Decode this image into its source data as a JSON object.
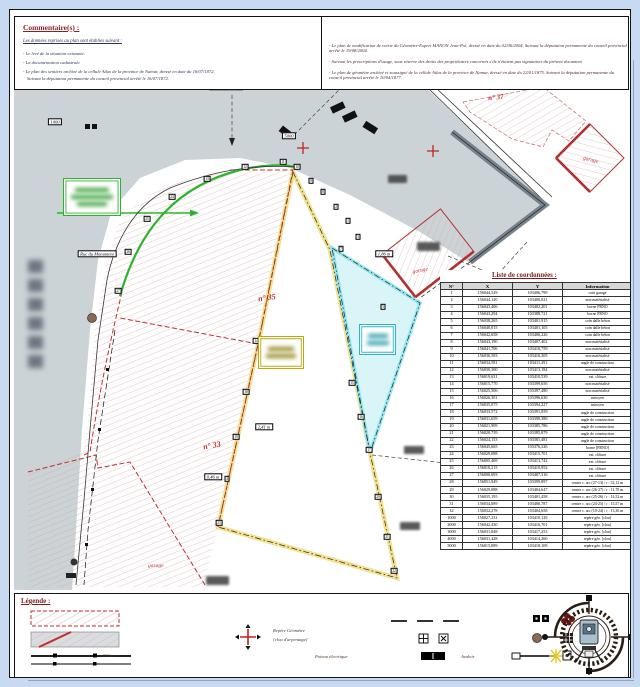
{
  "comments": {
    "title": "Commentaire(s) :",
    "intro": "Les données reprises au plan sont établies suivant :",
    "left_items": [
      "- Le levé de la situation existante.",
      "- La documentation cadastrale.",
      "- Le plan des sentiers archivé de la cellule Atlas de la province de Namur, dressé en date du 16/07/1872.",
      "Suivant la députation permanente du conseil provincial arrêté le 16/07/1872."
    ],
    "right_items": [
      "- Le plan de modification de voirie du Géomètre-Expert MANON Jean-Pol, dressé en date du 02/06/2004. Suivant la députation permanente du conseil provincial arrêté le 19/08/2004.",
      "- Suivant les prescriptions d'usage, sous réserve des droits des propriétaires concernés s'ils n'étaient pas signataires du présent document.",
      "- Le plan de géomètre archivé et soussigné de la cellule Atlas de la province de Namur, dressé en date du 22/01/1875. Suivant la députation permanente du conseil provincial arrêté le 10/04/1877."
    ]
  },
  "map": {
    "labels": {
      "street": "Rue du Monument",
      "parcel35": "n° 35",
      "parcel33": "n° 33",
      "parcel37": "n° 37",
      "garage_center": "garage",
      "garage_topright": "garage",
      "garage_bottomleft": "garage"
    },
    "chips": [
      {
        "x": 226,
        "y": 87,
        "text": "4000 | à 3,00 m"
      },
      {
        "x": 289,
        "y": 136,
        "text": "5000"
      },
      {
        "x": 55,
        "y": 122,
        "text": "1000"
      },
      {
        "x": 97,
        "y": 254,
        "text": "Rue du Monument"
      },
      {
        "x": 213,
        "y": 477,
        "text": "0,46 m"
      },
      {
        "x": 384,
        "y": 254,
        "text": "1,86 m"
      },
      {
        "x": 264,
        "y": 427,
        "text": "2,41 m"
      }
    ],
    "markers": [
      {
        "x": 118,
        "y": 291,
        "n": "27"
      },
      {
        "x": 128,
        "y": 252,
        "n": "26"
      },
      {
        "x": 147,
        "y": 219,
        "n": "25"
      },
      {
        "x": 172,
        "y": 197,
        "n": "24"
      },
      {
        "x": 207,
        "y": 179,
        "n": "13"
      },
      {
        "x": 245,
        "y": 167,
        "n": "12"
      },
      {
        "x": 283,
        "y": 162,
        "n": "11"
      },
      {
        "x": 297,
        "y": 167,
        "n": "10"
      },
      {
        "x": 311,
        "y": 181,
        "n": "9"
      },
      {
        "x": 323,
        "y": 192,
        "n": "8"
      },
      {
        "x": 336,
        "y": 207,
        "n": "2"
      },
      {
        "x": 348,
        "y": 221,
        "n": "1"
      },
      {
        "x": 341,
        "y": 249,
        "n": "7"
      },
      {
        "x": 358,
        "y": 237,
        "n": "3"
      },
      {
        "x": 383,
        "y": 307,
        "n": "5"
      },
      {
        "x": 391,
        "y": 330,
        "n": "6"
      },
      {
        "x": 352,
        "y": 383,
        "n": "15"
      },
      {
        "x": 361,
        "y": 417,
        "n": "16"
      },
      {
        "x": 369,
        "y": 450,
        "n": "17"
      },
      {
        "x": 378,
        "y": 497,
        "n": "20"
      },
      {
        "x": 387,
        "y": 537,
        "n": "21"
      },
      {
        "x": 394,
        "y": 571,
        "n": "22"
      },
      {
        "x": 219,
        "y": 523,
        "n": "23"
      },
      {
        "x": 256,
        "y": 341,
        "n": "14"
      },
      {
        "x": 246,
        "y": 392,
        "n": "18"
      },
      {
        "x": 236,
        "y": 437,
        "n": "19"
      },
      {
        "x": 227,
        "y": 479,
        "n": "4"
      }
    ],
    "colors": {
      "road": "#ccd3d6",
      "parcel_line": "#c03030",
      "lot_yellow": "#f3e08e",
      "lot_cyan": "#39bccb",
      "green": "#2cb52c"
    }
  },
  "table": {
    "title": "Liste de coordonnées :",
    "headers": [
      "N°",
      "X",
      "Y",
      "Information"
    ],
    "rows": [
      [
        "1",
        "156044,529",
        "103406,799",
        "coin garage"
      ],
      [
        "2",
        "156044,120",
        "103406,021",
        "non matérialisé"
      ],
      [
        "3",
        "156043,406",
        "103402,201",
        "borne FRNO"
      ],
      [
        "4",
        "156043,294",
        "103388,721",
        "borne FRNO"
      ],
      [
        "5",
        "156038,265",
        "103401,915",
        "coin dalle béton"
      ],
      [
        "6",
        "156040,015",
        "103401,105",
        "coin dalle béton"
      ],
      [
        "7",
        "156042,658",
        "103406,226",
        "coin dalle béton"
      ],
      [
        "8",
        "156043,190",
        "103407,402",
        "non matérialisé"
      ],
      [
        "9",
        "156041,706",
        "103410,759",
        "non matérialisé"
      ],
      [
        "10",
        "156036,583",
        "103416,305",
        "non matérialisé"
      ],
      [
        "11",
        "156034,581",
        "103411,291",
        "angle de construction"
      ],
      [
        "12",
        "156030,300",
        "103413,184",
        "non matérialisé"
      ],
      [
        "13",
        "156019,631",
        "103410,539",
        "ext. clôture"
      ],
      [
        "14",
        "156015,770",
        "103399,656",
        "non matérialisé"
      ],
      [
        "15",
        "156025,506",
        "103397,480",
        "non matérialisé"
      ],
      [
        "16",
        "156026,301",
        "103396,630",
        "mitoyen"
      ],
      [
        "17",
        "156035,075",
        "103394,227",
        "mitoyen"
      ],
      [
        "18",
        "156033,572",
        "103391,059",
        "angle de construction"
      ],
      [
        "19",
        "156031,659",
        "103390,389",
        "angle de construction"
      ],
      [
        "20",
        "156021,909",
        "103385,786",
        "angle de construction"
      ],
      [
        "21",
        "156020,739",
        "103385,879",
        "angle de construction"
      ],
      [
        "22",
        "156024,153",
        "103381,481",
        "angle de construction"
      ],
      [
        "23",
        "156045,665",
        "103376,326",
        "borne [FRNO]"
      ],
      [
        "24",
        "156029,088",
        "103415,701",
        "ext. clôture"
      ],
      [
        "25",
        "156005,469",
        "103413,742",
        "ext. clôture"
      ],
      [
        "26",
        "156010,215",
        "103410,952",
        "ext. clôture"
      ],
      [
        "27",
        "156000,693",
        "103407,316",
        "ext. clôture"
      ],
      [
        "28",
        "156051,949",
        "103399,897",
        "centre c. arc (27-13) / r : 52,12 m"
      ],
      [
        "29",
        "156029,088",
        "103404,647",
        "centre c. arc (26-27) / r : 11,70 m"
      ],
      [
        "30",
        "156035,195",
        "103401,458",
        "centre c. arc (25-26) / r : 14,52 m"
      ],
      [
        "31",
        "156034,089",
        "103400,787",
        "centre c. arc (24-25) / r : 15,57 m"
      ],
      [
        "32",
        "156032,278",
        "103404,658",
        "centre c. arc (10-24) / r : 13,36 m"
      ],
      [
        "1000",
        "156027,231",
        "103410,129",
        "repère géo. [clou]"
      ],
      [
        "2000",
        "156042,430",
        "103416,701",
        "repère géo. [clou]"
      ],
      [
        "3000",
        "156031,848",
        "103417,253",
        "repère géo. [clou]"
      ],
      [
        "4000",
        "156031,428",
        "103414,260",
        "repère géo. [clou]"
      ],
      [
        "5000",
        "156015,089",
        "103418,109",
        "repère géo. [clou]"
      ]
    ]
  },
  "legend": {
    "title": "Légende :",
    "labels": {
      "cloture": "Clôture",
      "avaloir": "Avaloir",
      "poteau": "Poteau électrique",
      "repere_line1": "Repère Géomètre",
      "repere_line2": "[clou d'arpentage]"
    }
  }
}
